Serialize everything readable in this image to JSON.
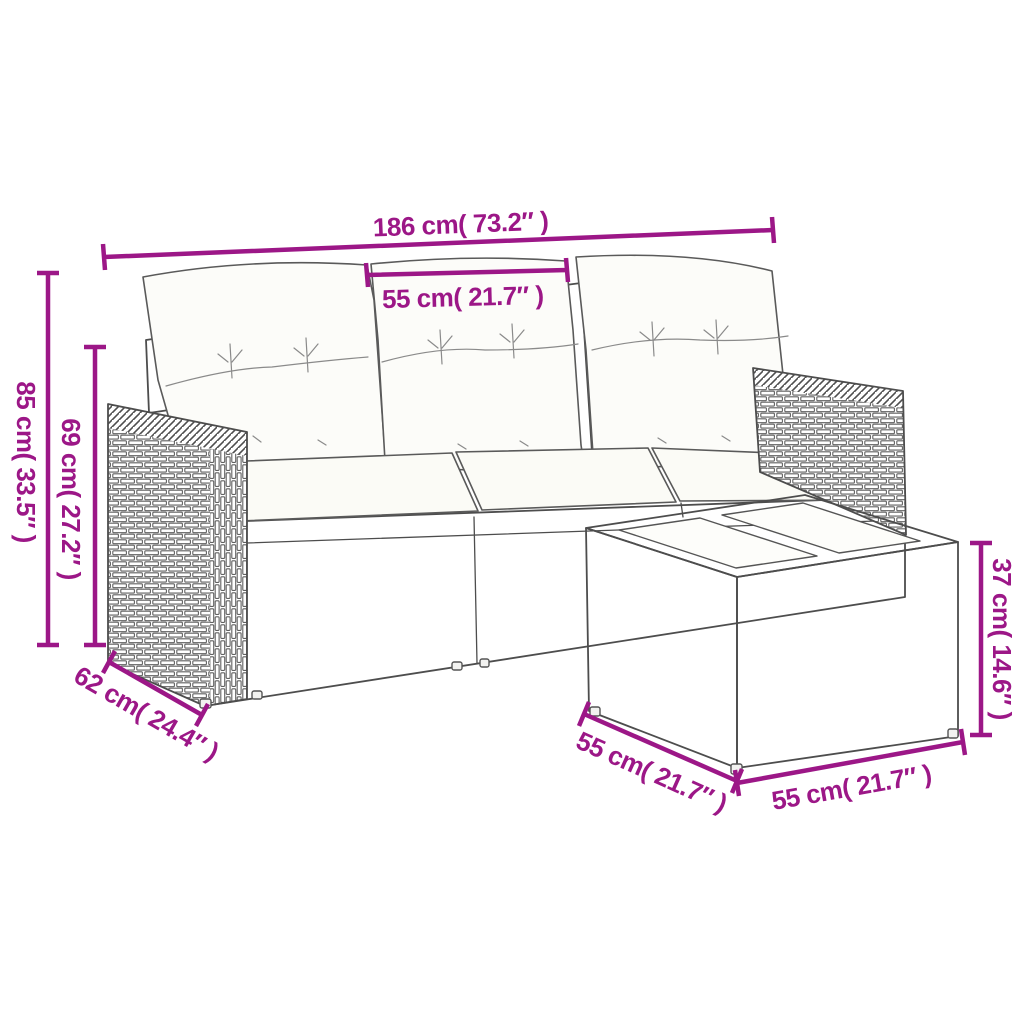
{
  "title": "Rattan garden lounge set — dimension diagram",
  "colors": {
    "dimension": "#9C1787",
    "line_art": "#4d4d4d",
    "weave_line": "#606060",
    "background": "#ffffff",
    "cushion": "#fcfcf9"
  },
  "furniture": {
    "sofa": "3-seater poly rattan sofa with back pillows and seat cushions",
    "table": "poly rattan side table with glass top panels"
  },
  "dimensions": {
    "sofa_width": {
      "label": "186 cm( 73.2″ )",
      "cm": 186,
      "inches": 73.2
    },
    "seat_width": {
      "label": "55 cm( 21.7″ )",
      "cm": 55,
      "inches": 21.7
    },
    "sofa_height": {
      "label": "85 cm( 33.5″ )",
      "cm": 85,
      "inches": 33.5
    },
    "backrest_height": {
      "label": "69 cm( 27.2″ )",
      "cm": 69,
      "inches": 27.2
    },
    "sofa_depth": {
      "label": "62 cm( 24.4″ )",
      "cm": 62,
      "inches": 24.4
    },
    "table_depth": {
      "label": "55 cm( 21.7″ )",
      "cm": 55,
      "inches": 21.7
    },
    "table_width": {
      "label": "55 cm( 21.7″ )",
      "cm": 55,
      "inches": 21.7
    },
    "table_height": {
      "label": "37 cm( 14.6″ )",
      "cm": 37,
      "inches": 14.6
    }
  }
}
